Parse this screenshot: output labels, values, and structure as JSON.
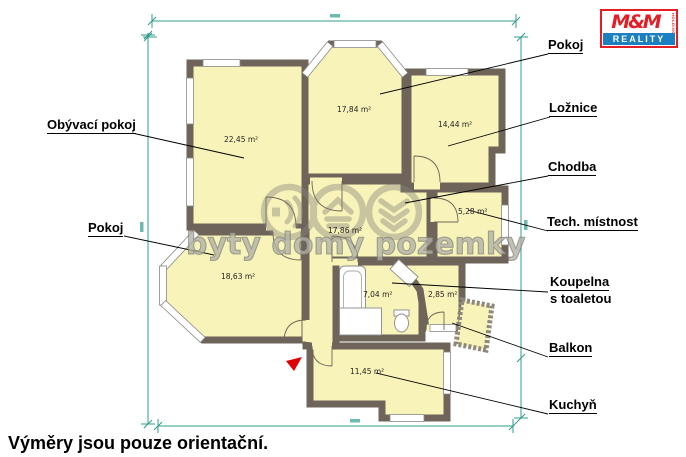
{
  "page": {
    "disclaimer": "Výměry jsou pouze orientační."
  },
  "branding": {
    "logo_top": "M&M",
    "logo_holding": "HOLDING",
    "logo_bottom": "REALITY",
    "watermark": "byty domy pozemky"
  },
  "rooms": {
    "obyvaci_pokoj": {
      "label": "Obývací pokoj",
      "area": "22,45 m²"
    },
    "pokoj_top": {
      "label": "Pokoj",
      "area": "17,84 m²"
    },
    "loznice": {
      "label": "Ložnice",
      "area": "14,44 m²"
    },
    "chodba": {
      "label": "Chodba",
      "area": "17,86 m²"
    },
    "tech_mistnost": {
      "label": "Tech. místnost",
      "area": "5,28 m²"
    },
    "pokoj_left": {
      "label": "Pokoj",
      "area": "18,63 m²"
    },
    "koupelna": {
      "label_line1": "Koupelna",
      "label_line2": "s toaletou",
      "area": "7,04 m²"
    },
    "balkon": {
      "label": "Balkon",
      "area": "2,85 m²"
    },
    "kuchyn": {
      "label": "Kuchyň",
      "area": "11,45 m²"
    }
  },
  "colors": {
    "wall": "#6e6459",
    "room_fill": "#f8f4b9",
    "dimension": "#2f9c8e",
    "watermark": "#84847c",
    "logo_red": "#e31e24",
    "logo_blue": "#1b7fc0",
    "arrow_red": "#dd0000"
  }
}
